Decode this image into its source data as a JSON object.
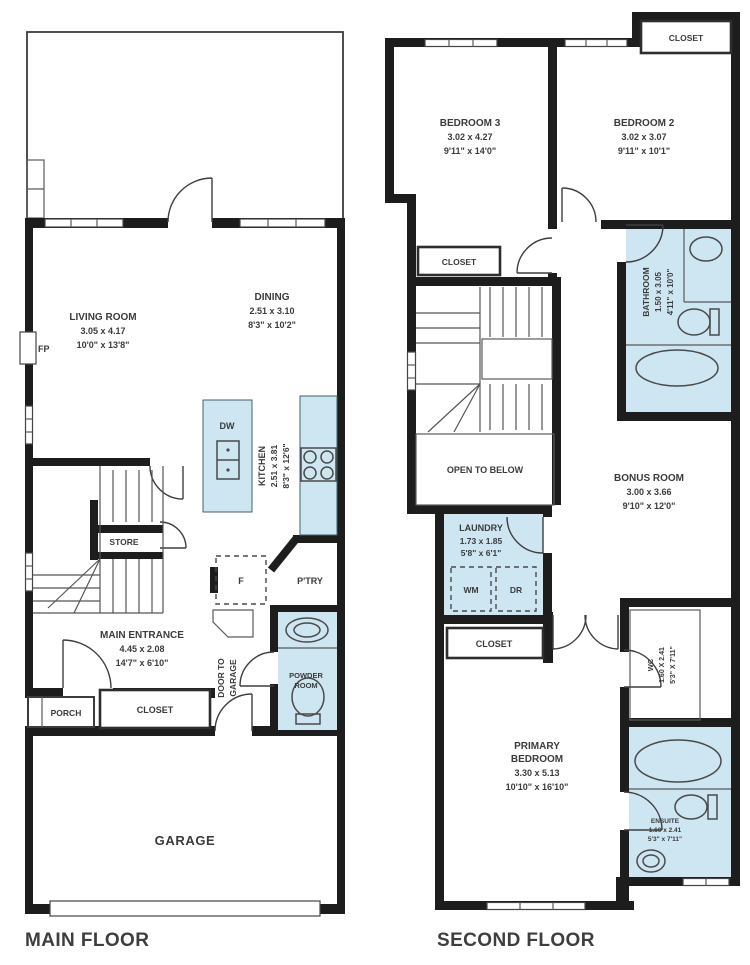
{
  "colors": {
    "wall": "#1d1d1d",
    "wet_area": "#cde6f2",
    "text": "#3b3b3b"
  },
  "main_floor": {
    "floor_label": "MAIN FLOOR",
    "living_room": {
      "name": "LIVING ROOM",
      "metric": "3.05 x 4.17",
      "imperial": "10'0\" x 13'8\""
    },
    "dining": {
      "name": "DINING",
      "metric": "2.51 x 3.10",
      "imperial": "8'3\" x 10'2\""
    },
    "kitchen": {
      "name": "KITCHEN",
      "metric": "2.51 x 3.81",
      "imperial": "8'3\" x 12'6\""
    },
    "main_entrance": {
      "name": "MAIN ENTRANCE",
      "metric": "4.45 x 2.08",
      "imperial": "14'7\" x 6'10\""
    },
    "store": "STORE",
    "pantry": "P'TRY",
    "fridge": "F",
    "dishwasher": "DW",
    "fireplace": "FP",
    "powder_room": {
      "line1": "POWDER",
      "line2": "ROOM"
    },
    "door_to_garage": {
      "line1": "DOOR TO",
      "line2": "GARAGE"
    },
    "porch": "PORCH",
    "closet": "CLOSET",
    "garage": "GARAGE"
  },
  "second_floor": {
    "floor_label": "SECOND FLOOR",
    "bedroom3": {
      "name": "BEDROOM 3",
      "metric": "3.02 x 4.27",
      "imperial": "9'11\" x 14'0\""
    },
    "bedroom2": {
      "name": "BEDROOM 2",
      "metric": "3.02 x 3.07",
      "imperial": "9'11\" x 10'1\""
    },
    "bathroom": {
      "name": "BATHROOM",
      "metric": "1.50 x 3.05",
      "imperial": "4'11\" x 10'0\""
    },
    "closet_top": "CLOSET",
    "closet_hall": "CLOSET",
    "closet_primary": "CLOSET",
    "open_to_below": "OPEN TO BELOW",
    "laundry": {
      "name": "LAUNDRY",
      "metric": "1.73 x 1.85",
      "imperial": "5'8\" x 6'1\"",
      "washer": "WM",
      "dryer": "DR"
    },
    "bonus_room": {
      "name": "BONUS ROOM",
      "metric": "3.00 x 3.66",
      "imperial": "9'10\" x 12'0\""
    },
    "wc": {
      "name": "WC",
      "metric": "1.60 X 2.41",
      "imperial": "5'3\" X 7'11\""
    },
    "primary_bedroom": {
      "line1": "PRIMARY",
      "line2": "BEDROOM",
      "metric": "3.30 x 5.13",
      "imperial": "10'10\" x 16'10\""
    },
    "ensuite": {
      "name": "ENSUITE",
      "metric": "1.60 x 2.41",
      "imperial": "5'3\" x 7'11\""
    }
  }
}
